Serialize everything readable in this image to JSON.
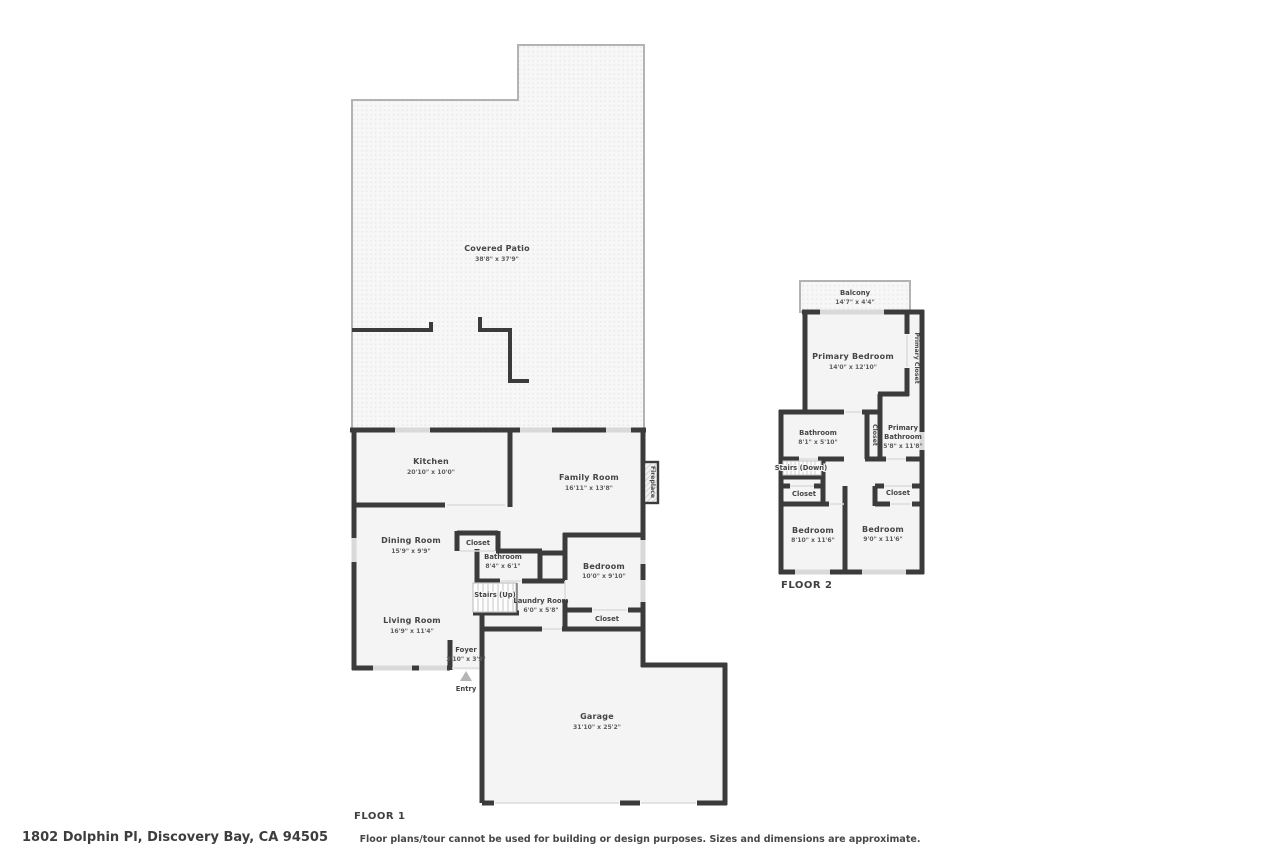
{
  "meta": {
    "address": "1802 Dolphin Pl, Discovery Bay, CA 94505",
    "disclaimer": "Floor plans/tour cannot be used for building or design purposes. Sizes and dimensions are approximate."
  },
  "colors": {
    "wall": "#3b3b3b",
    "room_fill": "#f4f4f4",
    "window": "#d9d9d9",
    "label": "#454545"
  },
  "floor1": {
    "label": "FLOOR 1",
    "rooms": [
      {
        "name": "Covered Patio",
        "dims": "38'8\" x 37'9\""
      },
      {
        "name": "Kitchen",
        "dims": "20'10\" x 10'0\""
      },
      {
        "name": "Family Room",
        "dims": "16'11\" x 13'8\""
      },
      {
        "name": "Dining Room",
        "dims": "15'9\" x 9'9\""
      },
      {
        "name": "Closet",
        "dims": ""
      },
      {
        "name": "Bathroom",
        "dims": "8'4\" x 6'1\""
      },
      {
        "name": "Stairs (Up)",
        "dims": ""
      },
      {
        "name": "Laundry Room",
        "dims": "6'0\" x 5'8\""
      },
      {
        "name": "Bedroom",
        "dims": "10'0\" x 9'10\""
      },
      {
        "name": "Closet",
        "dims": ""
      },
      {
        "name": "Living Room",
        "dims": "16'9\" x 11'4\""
      },
      {
        "name": "Foyer",
        "dims": "3'10\" x 3'9\""
      },
      {
        "name": "Garage",
        "dims": "31'10\" x 25'2\""
      }
    ],
    "annotations": {
      "entry": "Entry",
      "fireplace": "Fireplace"
    }
  },
  "floor2": {
    "label": "FLOOR 2",
    "rooms": [
      {
        "name": "Balcony",
        "dims": "14'7\" x 4'4\""
      },
      {
        "name": "Primary Bedroom",
        "dims": "14'0\" x 12'10\""
      },
      {
        "name": "Primary Closet",
        "dims": ""
      },
      {
        "name": "Bathroom",
        "dims": "8'1\" x 5'10\""
      },
      {
        "name": "Closet",
        "dims": ""
      },
      {
        "name": "Primary",
        "name2": "Bathroom",
        "dims": "5'8\" x 11'8\""
      },
      {
        "name": "Stairs (Down)",
        "dims": ""
      },
      {
        "name": "Closet",
        "dims": ""
      },
      {
        "name": "Closet",
        "dims": ""
      },
      {
        "name": "Bedroom",
        "dims": "8'10\" x 11'6\""
      },
      {
        "name": "Bedroom",
        "dims": "9'0\" x 11'6\""
      }
    ]
  }
}
